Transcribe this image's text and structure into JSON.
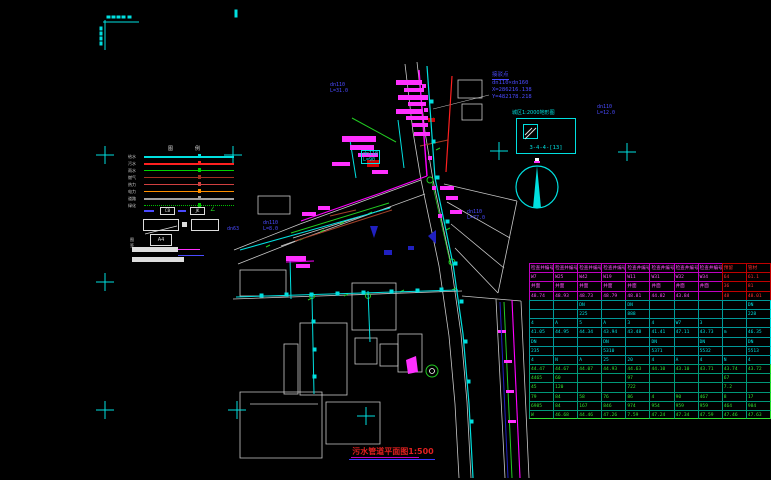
{
  "window": {
    "width": 771,
    "height": 480,
    "background": "#000000"
  },
  "colors": {
    "cyan": "#00e0e0",
    "magenta": "#ff00ff",
    "red": "#ff2020",
    "green": "#22cc22",
    "blue": "#4a4aff",
    "white": "#dddddd"
  },
  "coord_block": {
    "point_label": "接驳点",
    "size_label": "dn110×dn160",
    "x_label": "X=286216.138",
    "y_label": "Y=482178.218"
  },
  "detail_box": {
    "caption": "城区1:2000地形图",
    "sheet_number": "3-4-4-[13]"
  },
  "legend": {
    "header": "图例",
    "rows": [
      {
        "label": "给水",
        "color": "#00e0e0",
        "thick": 2,
        "dotted": false
      },
      {
        "label": "污水",
        "color": "#ff2020",
        "thick": 2,
        "dotted": false
      },
      {
        "label": "雨水",
        "color": "#00d400",
        "thick": 1,
        "dotted": false
      },
      {
        "label": "燃气",
        "color": "#a03020",
        "thick": 1,
        "dotted": false
      },
      {
        "label": "热力",
        "color": "#d04040",
        "thick": 1,
        "dotted": false
      },
      {
        "label": "电力",
        "color": "#ff9000",
        "thick": 1,
        "dotted": false
      },
      {
        "label": "道路",
        "color": "#a0a0a0",
        "thick": 2,
        "dotted": false
      },
      {
        "label": "绿化",
        "color": "#00c000",
        "thick": 1,
        "dotted": true
      }
    ],
    "symbols": {
      "box1": "CB",
      "box2": "JK",
      "angle": "∠"
    },
    "scale_label": "图签",
    "scale_value": "A4"
  },
  "drawing_labels": [
    {
      "l1": "dn110",
      "l2": "L=31.0",
      "x": 330,
      "y": 82,
      "color": "blue",
      "boxed": false
    },
    {
      "l1": "dn110",
      "l2": "L=90",
      "x": 361,
      "y": 150,
      "color": "cyan",
      "boxed": true
    },
    {
      "l1": "dn63",
      "l2": "",
      "x": 227,
      "y": 226,
      "color": "blue",
      "boxed": false
    },
    {
      "l1": "dn110",
      "l2": "L=8.0",
      "x": 263,
      "y": 220,
      "color": "blue",
      "boxed": false
    },
    {
      "l1": "dn110",
      "l2": "L=77.0",
      "x": 467,
      "y": 209,
      "color": "blue",
      "boxed": false
    },
    {
      "l1": "dn110",
      "l2": "L=12.0",
      "x": 597,
      "y": 104,
      "color": "blue",
      "boxed": false
    }
  ],
  "title": {
    "text": "污水管道平面图1:500"
  },
  "table": {
    "rows": [
      {
        "c": "rm",
        "red": [
          8,
          9
        ],
        "cells": [
          "检查井编号",
          "检查井编号",
          "检查井编号",
          "检查井编号",
          "检查井编号",
          "检查井编号",
          "检查井编号",
          "检查井编号",
          "预留",
          "管材"
        ]
      },
      {
        "c": "rm",
        "red": [
          8,
          9
        ],
        "cells": [
          "W7",
          "W25",
          "W42",
          "W19",
          "W11",
          "W31",
          "W32",
          "W34",
          "64",
          "61.1"
        ]
      },
      {
        "c": "rm",
        "red": [
          8,
          9
        ],
        "cells": [
          "井面",
          "井面",
          "井面",
          "井面",
          "井面",
          "井面",
          "井面",
          "井面",
          "36",
          "81"
        ]
      },
      {
        "c": "rm",
        "red": [
          8,
          9
        ],
        "cells": [
          "48.74",
          "48.93",
          "48.73",
          "48.79",
          "48.81",
          "44.82",
          "43.84",
          "",
          "48",
          "48.01"
        ]
      },
      {
        "c": "rc",
        "red": [],
        "cells": [
          "",
          "",
          "DN",
          "",
          "DN",
          "",
          "",
          "",
          "",
          "DN"
        ]
      },
      {
        "c": "rc",
        "red": [],
        "cells": [
          "",
          "",
          "225",
          "",
          "888",
          "",
          "",
          "",
          "",
          "228"
        ]
      },
      {
        "c": "rc",
        "red": [],
        "cells": [
          "4",
          "A",
          "5",
          "A",
          "3",
          "4",
          "W7",
          "3",
          "",
          ""
        ]
      },
      {
        "c": "rc",
        "red": [],
        "cells": [
          "41.05",
          "44.95",
          "44.34",
          "43.94",
          "43.48",
          "41.41",
          "47.11",
          "43.73",
          "m",
          "46.35"
        ]
      },
      {
        "c": "rc",
        "red": [],
        "cells": [
          "DN",
          "",
          "",
          "DN",
          "",
          "DN",
          "",
          "DN",
          "",
          "DN"
        ]
      },
      {
        "c": "rc",
        "red": [],
        "cells": [
          "235",
          "",
          "",
          "5310",
          "",
          "5371",
          "",
          "5532",
          "",
          "5513"
        ]
      },
      {
        "c": "rc",
        "red": [],
        "cells": [
          "4",
          "N",
          "A",
          "25",
          "20",
          "4",
          "A",
          "4",
          "N",
          "4"
        ]
      },
      {
        "c": "rg",
        "red": [],
        "cells": [
          "44.47",
          "44.67",
          "44.07",
          "44.93",
          "44.63",
          "44.10",
          "43.10",
          "43.71",
          "43.74",
          "43.72"
        ]
      },
      {
        "c": "rg",
        "red": [],
        "cells": [
          "4465",
          "60",
          "",
          "",
          "97",
          "",
          "",
          "",
          "67",
          ""
        ]
      },
      {
        "c": "rg",
        "red": [],
        "cells": [
          "45",
          "120",
          "",
          "",
          "722",
          "",
          "",
          "",
          "7.2",
          ""
        ]
      },
      {
        "c": "rg",
        "red": [],
        "cells": [
          "79",
          "84",
          "58",
          "76",
          "86",
          "4",
          "90",
          "467",
          "8",
          "17"
        ]
      },
      {
        "c": "rg",
        "red": [],
        "cells": [
          "6985",
          "84",
          "167",
          "846",
          "974",
          "954",
          "959",
          "959",
          "464",
          "984"
        ]
      },
      {
        "c": "rg",
        "red": [],
        "cells": [
          "W",
          "46.68",
          "44.46",
          "47.26",
          "7.59",
          "47.24",
          "47.34",
          "47.59",
          "47.46",
          "47.63"
        ]
      }
    ]
  }
}
